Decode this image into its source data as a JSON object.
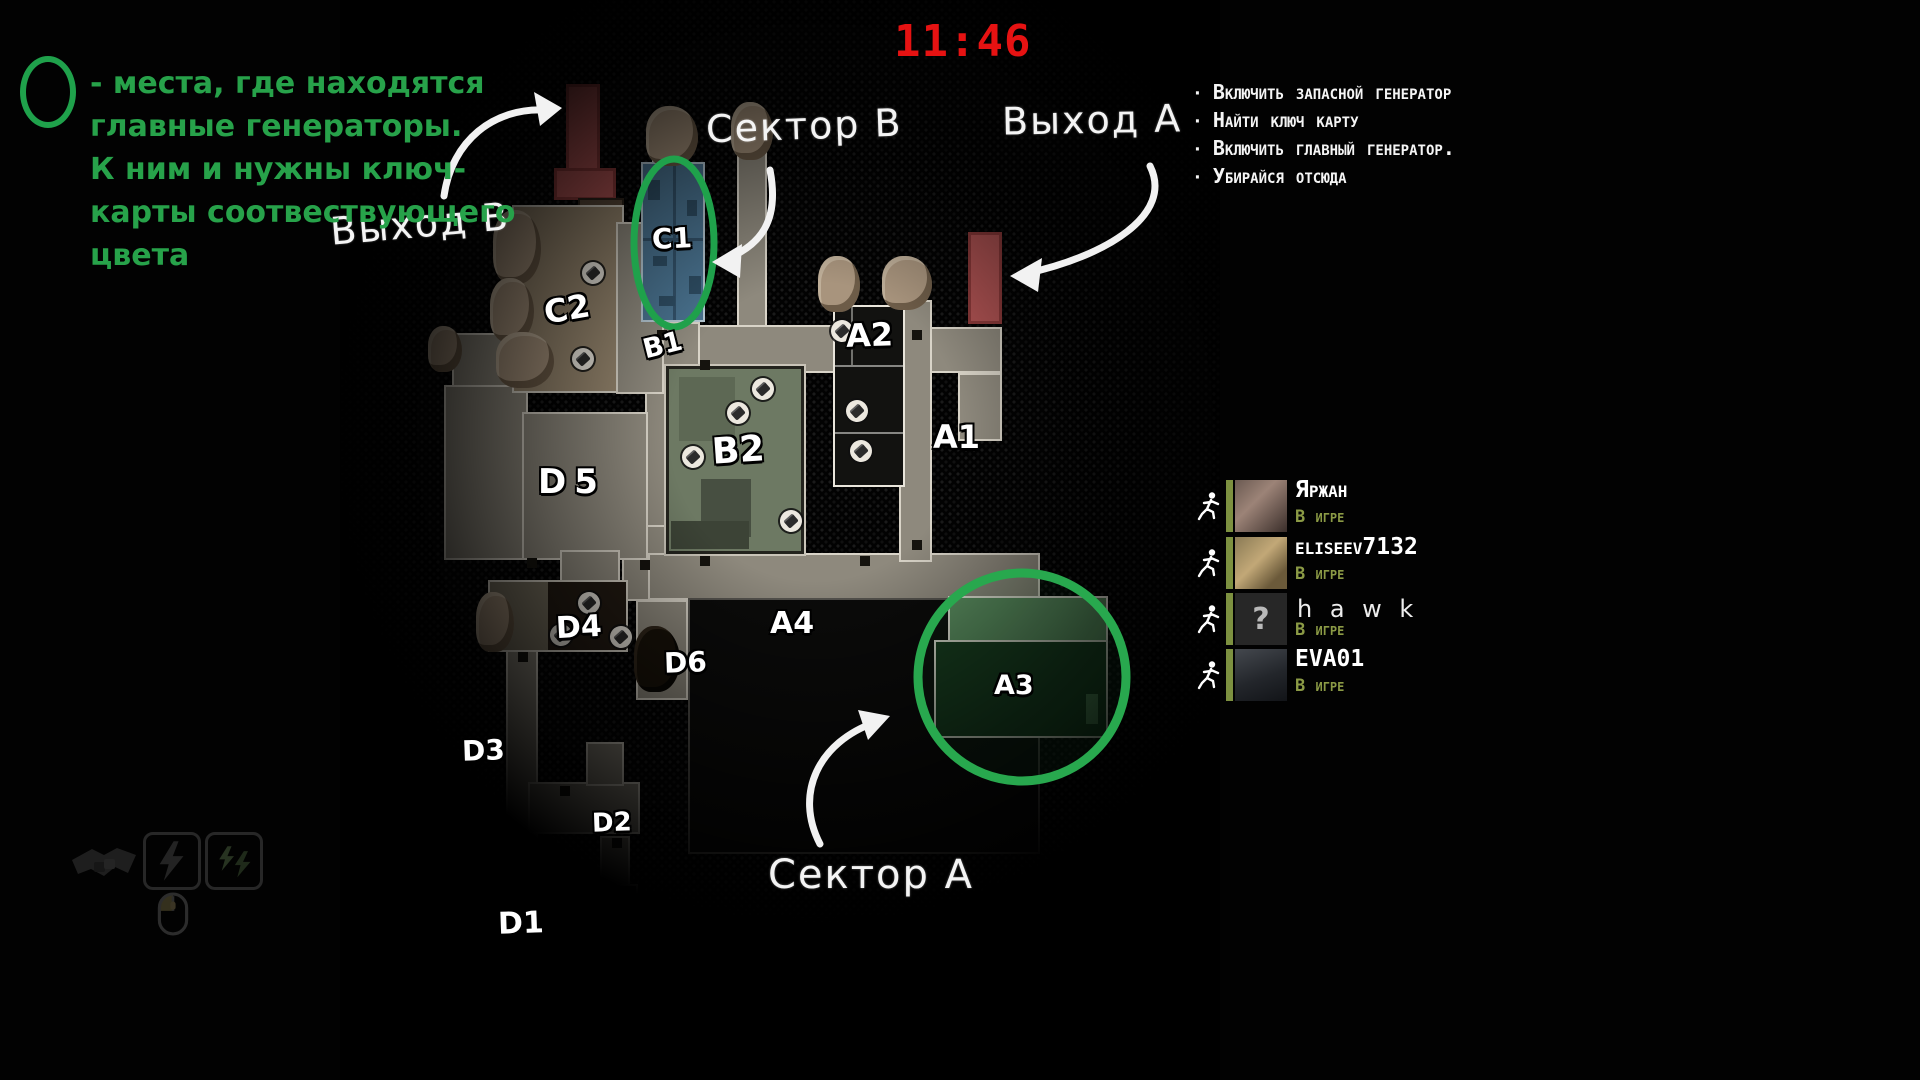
{
  "hud": {
    "timer": "11:46",
    "legend": {
      "lines": [
        "- места, где находятся",
        "главные генераторы.",
        "К ним и нужны ключ-",
        "карты соотвествующего",
        "цвета"
      ]
    },
    "tasks": {
      "bullet": "·",
      "items": [
        "Включить запасной генератор",
        "Найти ключ карту",
        "Включить главный генератор.",
        "Убирайся отсюда"
      ]
    }
  },
  "map": {
    "annotations": {
      "sector_b": "Сектор B",
      "exit_a": "Выход A",
      "exit_b": "Выход В",
      "sector_a": "Сектор A"
    },
    "room_labels": [
      "C1",
      "C2",
      "B1",
      "B2",
      "A1",
      "A2",
      "A3",
      "A4",
      "D1",
      "D2",
      "D3",
      "D4",
      "D5",
      "D6"
    ]
  },
  "players": [
    {
      "name": "Яржан",
      "status": "В игре",
      "avatar": "photo"
    },
    {
      "name": "eliseev7132",
      "status": "В игре",
      "avatar": "photo"
    },
    {
      "name": "h a w k",
      "status": "В игре",
      "avatar": "question",
      "glyph": "?"
    },
    {
      "name": "EVA01",
      "status": "В игре",
      "avatar": "photo"
    }
  ],
  "icons": {
    "runner-icon": "stick-figure-running",
    "handshake-icon": "dark-handshake-silhouette",
    "lightning-ability-icon": "lightning-bolt-in-rounded-box",
    "double-spark-ability-icon": "two-bolts-in-rounded-box",
    "mouse-hint-icon": "computer-mouse-outline",
    "keycard-icon": "white-circle-with-card",
    "question-mark-avatar": "?"
  },
  "colors": {
    "accent_green": "#27a24a",
    "circle_green": "#1fa14b",
    "timer_red": "#e61212",
    "status_green": "#8b9a45",
    "exit_door_red": "#b25454",
    "c1_room_blue": "#4a7390",
    "a3_room_green": "#16351b"
  }
}
